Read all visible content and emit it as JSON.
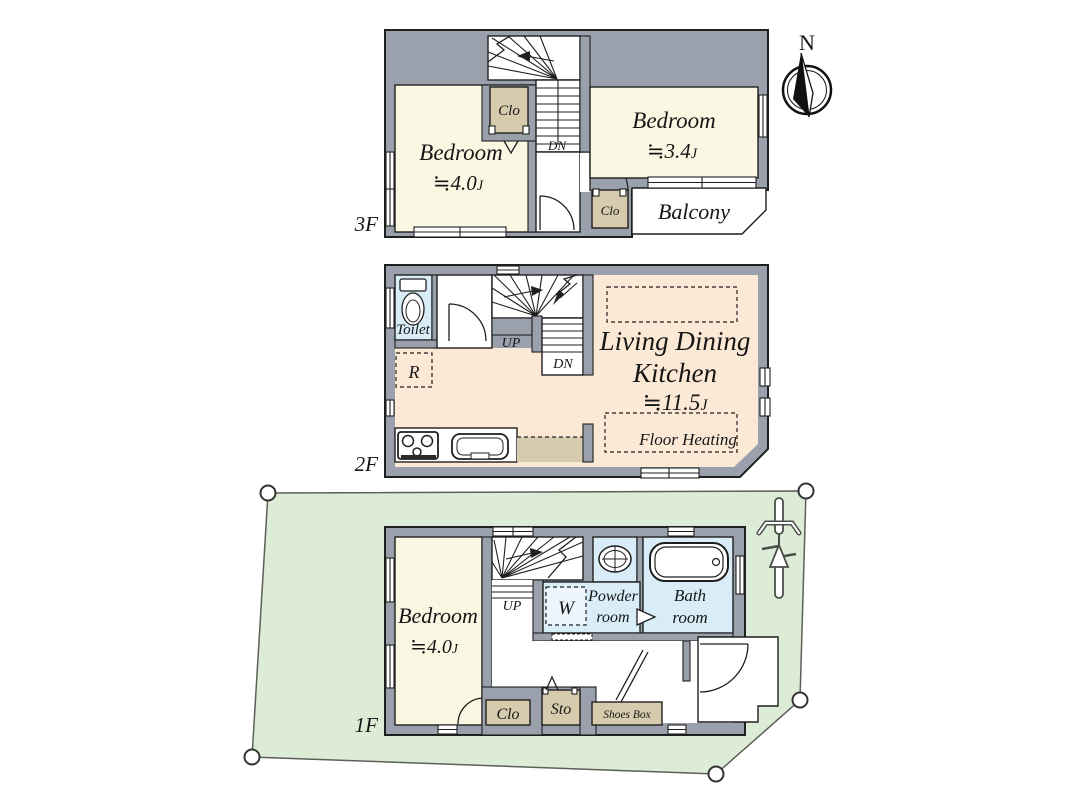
{
  "compass": {
    "north_label": "N"
  },
  "floor_3": {
    "floor_label": "3F",
    "bedroom_left": {
      "name": "Bedroom",
      "size_value": "≒4.0",
      "size_unit": "J"
    },
    "bedroom_right": {
      "name": "Bedroom",
      "size_value": "≒3.4",
      "size_unit": "J"
    },
    "closet_upper": {
      "label": "Clo"
    },
    "closet_lower": {
      "label": "Clo"
    },
    "balcony": {
      "label": "Balcony"
    },
    "stairs": {
      "down_label": "DN"
    }
  },
  "floor_2": {
    "floor_label": "2F",
    "toilet": {
      "label": "Toilet"
    },
    "refrigerator": {
      "label": "R"
    },
    "ldk": {
      "name_lines": [
        "Living Dining",
        "Kitchen"
      ],
      "size_value": "≒11.5",
      "size_unit": "J",
      "floor_heating_label": "Floor Heating"
    },
    "stairs": {
      "up_label": "UP",
      "down_label": "DN"
    }
  },
  "floor_1": {
    "floor_label": "1F",
    "bedroom": {
      "name": "Bedroom",
      "size_value": "≒4.0",
      "size_unit": "J"
    },
    "stairs": {
      "up_label": "UP"
    },
    "washer": {
      "label": "W"
    },
    "powder_room": {
      "name_lines": [
        "Powder",
        "room"
      ]
    },
    "bath_room": {
      "name_lines": [
        "Bath",
        "room"
      ]
    },
    "closet": {
      "label": "Clo"
    },
    "storage": {
      "label": "Sto"
    },
    "shoes_box": {
      "label": "Shoes Box"
    }
  },
  "colors": {
    "wall_gray": "#9aa1ac",
    "line_dark": "#1f1f1f",
    "room_cream": "#faf7e2",
    "closet_tan": "#d6cbad",
    "water_blue": "#d8edf8",
    "ldk_peach": "#fce9d5",
    "lot_green": "#dcecd7"
  }
}
